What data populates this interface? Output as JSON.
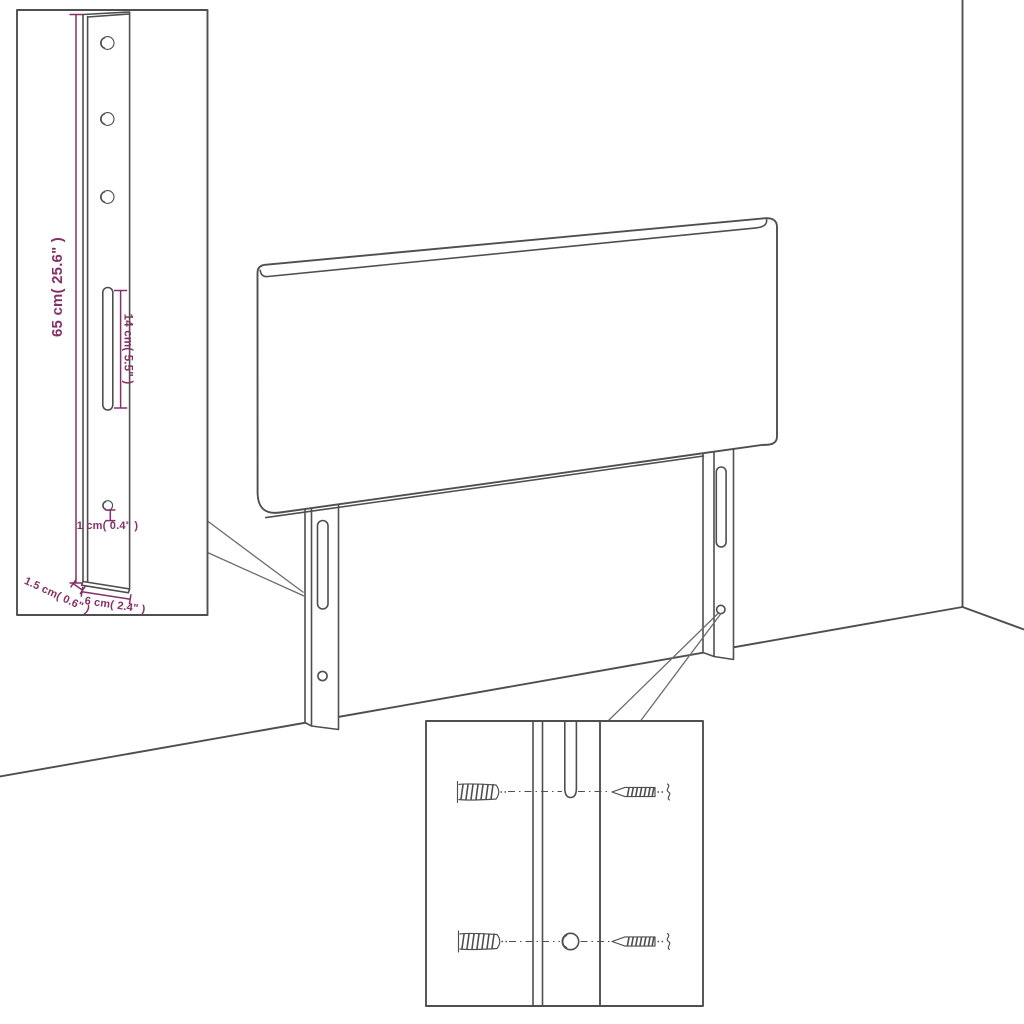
{
  "scene": {
    "description": "Technical line diagram of an upholstered headboard with two rear mounting legs, standing in a room corner, with two zoom-detail callouts",
    "background": "#ffffff"
  },
  "colors": {
    "line": "#4f4f4f",
    "dimension": "#843166",
    "connector": "#6b6b6b",
    "background": "#ffffff"
  },
  "leg_detail_callout": {
    "height_label": "65 cm( 25.6\" )",
    "slot_length_label": "14 cm( 5.5\" )",
    "hole_diameter_label": "1 cm( 0.4\" )",
    "thickness_label": "1.5 cm( 0.6\" )",
    "width_label": "6 cm( 2.4\" )"
  },
  "hardware_detail_callout": {
    "icons": [
      "wall-plug-icon",
      "mounting-slot",
      "round-hole",
      "screw-icon"
    ]
  }
}
